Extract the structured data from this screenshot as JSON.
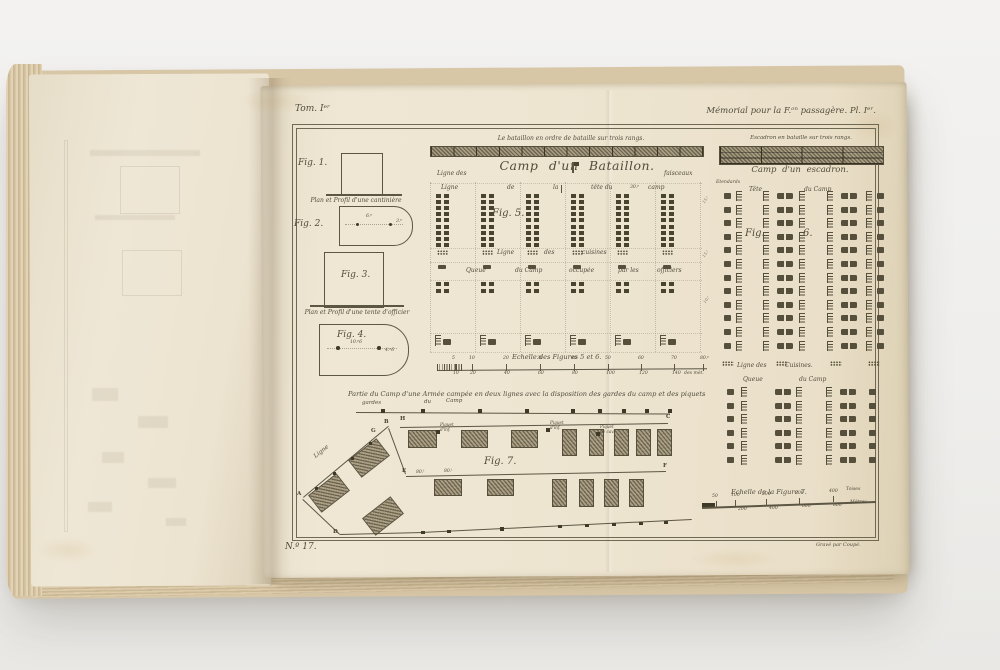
{
  "margins": {
    "top_left": "Tom. Iᵉʳ",
    "top_right": "Mémorial pour la F.ᵒⁿ passagère. Pl. Iᵉʳ.",
    "bottom_left": "N.º 17.",
    "bottom_right": "Gravé par Coupé."
  },
  "left_figs": {
    "fig1": "Fig. 1.",
    "caption_soldier": "Plan et Profil d'une cantinière",
    "fig2": "Fig. 2.",
    "fig2_dim_a": "6.ᵖ",
    "fig2_dim_b": "3.ᵖ",
    "fig3": "Fig. 3.",
    "caption_officer": "Plan et Profil d'une tente d'officier",
    "fig4": "Fig. 4.",
    "fig4_dim_a": "10.ᵖ6",
    "fig4_dim_b": "4.ᵖ6"
  },
  "battalion": {
    "order_caption": "Le bataillon en ordre de bataille sur trois rangs.",
    "title": "Camp d'un Bataillon.",
    "row1_left": "Ligne des",
    "row1_right": "faisceaux",
    "row2": [
      "Ligne",
      "de",
      "la",
      "tête du",
      "30.ᵖ",
      "camp"
    ],
    "fig5": "Fig. 5.",
    "cuisines": [
      "Ligne",
      "des",
      "cuisines"
    ],
    "queue": [
      "Queue",
      "du Camp",
      "occupée",
      "par les",
      "officiers"
    ],
    "edge_dims": [
      "15.ᵗ",
      "15.ᵗ",
      "10.ᵗ"
    ]
  },
  "scale56": {
    "title": "Echelle des Figures 5 et 6.",
    "top_ticks": [
      "5",
      "10",
      "20",
      "30",
      "40",
      "50",
      "60",
      "70",
      "80.ᵖ"
    ],
    "bottom_ticks": [
      "10",
      "20",
      "40",
      "60",
      "80",
      "100",
      "120",
      "140"
    ],
    "unit_right": "des mèt."
  },
  "squadron": {
    "order_caption": "Escadron en bataille sur trois rangs.",
    "title": "Camp d'un escadron.",
    "standards": "Etendards",
    "head_row": [
      "Tête",
      "du Camp"
    ],
    "fig6_a": "Fig.",
    "fig6_b": "6.",
    "cuisines": [
      "Ligne des",
      "Cuisines."
    ],
    "queue": [
      "Queue",
      "du Camp"
    ]
  },
  "fig7": {
    "caption": "Partie du Camp d'une Armée campée en deux lignes avec la disposition des gardes du camp et des piquets",
    "guards": [
      "gardes",
      "du",
      "Camp"
    ],
    "label": "Fig. 7.",
    "ligne": "Ligne",
    "letters": {
      "A": "A",
      "B": "B",
      "C": "C",
      "D": "D",
      "E": "E",
      "F": "F",
      "G": "G",
      "H": "H"
    },
    "piquets": [
      {
        "l1": "Piquet",
        "l2": "d'inf."
      },
      {
        "l1": "Piquet",
        "l2": "d'inf."
      },
      {
        "l1": "Piquet",
        "l2": "de cav."
      }
    ],
    "dims": [
      "80.ᵗ",
      "80.ᵗ"
    ]
  },
  "scale7": {
    "title": "Echelle de la Figure 7.",
    "top_ticks": [
      "50",
      "100",
      "200",
      "300",
      "400"
    ],
    "top_unit": "Toises",
    "bottom_ticks": [
      "200",
      "400",
      "600",
      "800"
    ],
    "bottom_unit": "Mètres"
  }
}
